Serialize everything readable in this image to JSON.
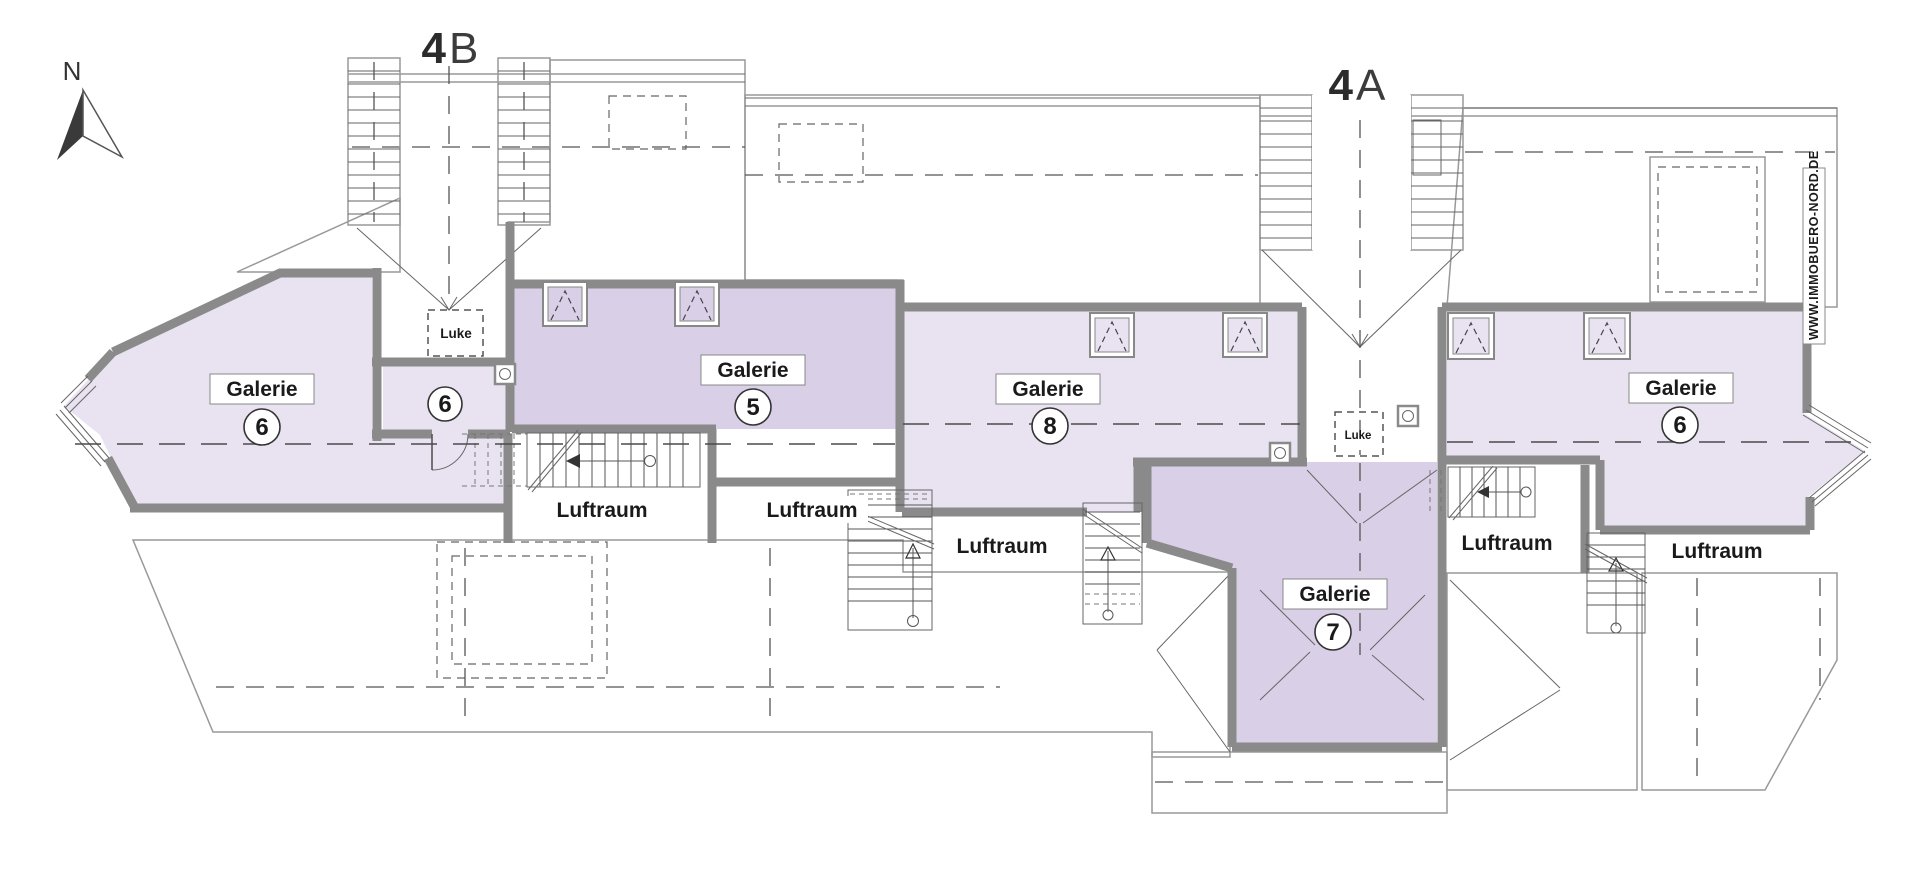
{
  "compass": {
    "north_label": "N"
  },
  "buildings": {
    "b4b": {
      "number": "4",
      "letter": "B"
    },
    "b4a": {
      "number": "4",
      "letter": "A"
    }
  },
  "rooms": {
    "galerie6_left": {
      "label": "Galerie",
      "number": "6"
    },
    "room6_small": {
      "number": "6"
    },
    "galerie5": {
      "label": "Galerie",
      "number": "5"
    },
    "galerie8": {
      "label": "Galerie",
      "number": "8"
    },
    "galerie7": {
      "label": "Galerie",
      "number": "7"
    },
    "galerie6_right": {
      "label": "Galerie",
      "number": "6"
    }
  },
  "voids": {
    "luftraum1": {
      "label": "Luftraum"
    },
    "luftraum2": {
      "label": "Luftraum"
    },
    "luftraum3": {
      "label": "Luftraum"
    },
    "luftraum4": {
      "label": "Luftraum"
    },
    "luftraum5": {
      "label": "Luftraum"
    }
  },
  "hatches": {
    "luke_left": {
      "label": "Luke"
    },
    "luke_right": {
      "label": "Luke"
    }
  },
  "watermark": {
    "text": "WWW.IMMOBUERO-NORD.DE"
  },
  "colors": {
    "room_light": "#e9e3f1",
    "room_dark": "#d9cfe6",
    "wall": "#8a8a8a"
  }
}
